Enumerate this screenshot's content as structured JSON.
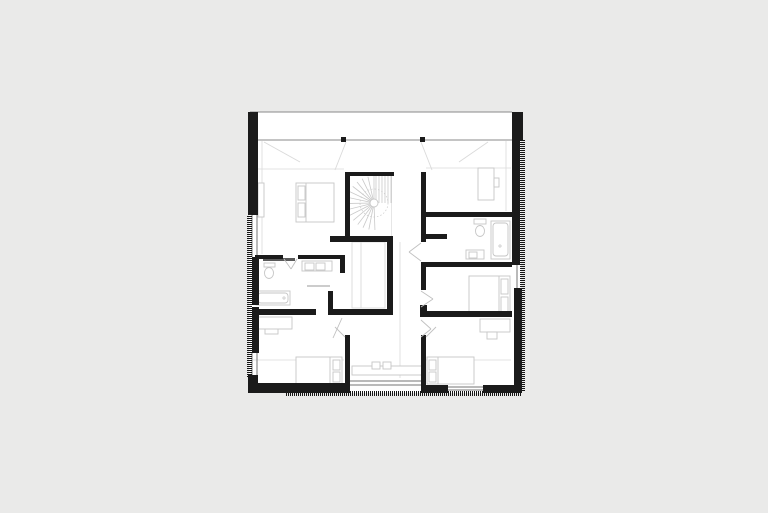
{
  "meta": {
    "type": "architectural-floor-plan",
    "description": "black-and-white attic floor plan with central spiral stair, bedrooms, two bathrooms and hatched exterior wall edges, centered on a light grey page"
  },
  "canvas": {
    "width": 768,
    "height": 513
  },
  "colors": {
    "background": "#eaeae9",
    "floor": "#ffffff",
    "wall": "#1b1b1b",
    "hatch": "#161616",
    "thin_line": "#757575",
    "band_line": "#8a8a8a",
    "faint_line": "#dadada",
    "furniture": "#c6c6c6",
    "stair_line": "#c9c9c9",
    "swing_line": "#c0c0c0",
    "slider_door": "#5a5a5a"
  },
  "plan": {
    "floor_rect": [
      249,
      112,
      272,
      281
    ],
    "band_lines": [
      [
        250,
        112,
        512,
        112
      ],
      [
        252,
        140,
        512,
        140
      ]
    ],
    "columns": [
      [
        341,
        137,
        5,
        5
      ],
      [
        420,
        137,
        5,
        5
      ]
    ],
    "walls": [
      [
        248,
        112,
        10,
        103
      ],
      [
        252,
        257,
        7,
        48
      ],
      [
        252,
        307,
        7,
        46
      ],
      [
        248,
        375,
        10,
        18
      ],
      [
        248,
        383,
        97,
        10
      ],
      [
        345,
        335,
        5,
        58
      ],
      [
        421,
        335,
        5,
        58
      ],
      [
        425,
        385,
        23,
        8
      ],
      [
        483,
        385,
        39,
        8
      ],
      [
        512,
        112,
        11,
        28
      ],
      [
        512,
        140,
        8,
        125
      ],
      [
        514,
        288,
        8,
        99
      ],
      [
        345,
        172,
        49,
        4
      ],
      [
        345,
        172,
        5,
        65
      ],
      [
        330,
        236,
        62,
        6
      ],
      [
        387,
        236,
        6,
        79
      ],
      [
        252,
        309,
        64,
        6
      ],
      [
        328,
        309,
        65,
        6
      ],
      [
        328,
        291,
        5,
        24
      ],
      [
        255,
        255,
        28,
        4
      ],
      [
        298,
        255,
        47,
        4
      ],
      [
        340,
        255,
        5,
        18
      ],
      [
        421,
        172,
        5,
        70
      ],
      [
        425,
        234,
        22,
        5
      ],
      [
        421,
        212,
        91,
        5
      ],
      [
        421,
        262,
        91,
        5
      ],
      [
        421,
        262,
        5,
        28
      ],
      [
        420,
        311,
        92,
        6
      ],
      [
        420,
        305,
        7,
        6
      ]
    ],
    "hatch_strips": {
      "left": [
        247,
        215,
        5,
        163
      ],
      "right": [
        520,
        140,
        5,
        252
      ],
      "bottom": [
        286,
        391,
        235,
        5
      ]
    },
    "window_lines": [
      [
        252,
        215,
        252,
        257
      ],
      [
        257,
        215,
        257,
        257
      ],
      [
        252,
        353,
        252,
        375
      ],
      [
        257,
        353,
        257,
        375
      ],
      [
        517,
        264,
        517,
        289
      ],
      [
        350,
        381,
        421,
        381
      ],
      [
        350,
        385,
        421,
        385
      ],
      [
        448,
        387,
        483,
        387
      ],
      [
        448,
        390,
        483,
        390
      ]
    ],
    "faint_lines": [
      [
        253,
        360,
        344,
        360
      ],
      [
        426,
        360,
        511,
        360
      ],
      [
        262,
        141,
        262,
        254
      ],
      [
        506,
        141,
        506,
        211
      ],
      [
        400,
        242,
        400,
        378
      ],
      [
        253,
        169,
        344,
        169
      ],
      [
        426,
        168,
        511,
        168
      ]
    ],
    "roof_splays": [
      [
        264,
        142,
        300,
        162
      ],
      [
        488,
        142,
        459,
        162
      ],
      [
        346,
        142,
        335,
        170
      ],
      [
        421,
        142,
        432,
        170
      ]
    ],
    "door_swings": [
      [
        421,
        243,
        409,
        252
      ],
      [
        409,
        252,
        421,
        261
      ],
      [
        421,
        291,
        433,
        299
      ],
      [
        433,
        299,
        421,
        307
      ],
      [
        421,
        320,
        431,
        329
      ],
      [
        431,
        329,
        421,
        337
      ],
      [
        284,
        259,
        291,
        269
      ],
      [
        291,
        269,
        297,
        259
      ],
      [
        342,
        318,
        333,
        338
      ],
      [
        345,
        337,
        335,
        327
      ],
      [
        426,
        337,
        436,
        327
      ]
    ],
    "stair": {
      "box": [
        350,
        176,
        42,
        61
      ],
      "cx": 374,
      "cy": 203,
      "hub_r": 4,
      "fan": {
        "r": 27,
        "start": 88,
        "end": 272,
        "step": 13
      },
      "treads_x": [
        376,
        379,
        382,
        385,
        388,
        391
      ],
      "treads_y_top": 176,
      "treads_y_bottom": 203,
      "edge_x": 392,
      "walk_r": 14
    },
    "furniture": {
      "beds": [
        {
          "rect": [
            296,
            183,
            38,
            39
          ],
          "divider_x": 306,
          "pillows": [
            [
              298,
              186,
              7,
              14
            ],
            [
              298,
              203,
              7,
              14
            ]
          ]
        },
        {
          "rect": [
            469,
            276,
            41,
            38
          ],
          "divider_x": 499,
          "pillows": [
            [
              501,
              279,
              7,
              15
            ],
            [
              501,
              297,
              7,
              15
            ]
          ]
        },
        {
          "rect": [
            427,
            357,
            47,
            27
          ],
          "divider_x": 438,
          "pillows": [
            [
              429,
              360,
              7,
              10
            ],
            [
              429,
              372,
              7,
              10
            ]
          ]
        },
        {
          "rect": [
            296,
            357,
            46,
            27
          ],
          "divider_x": 330,
          "pillows": [
            [
              333,
              360,
              7,
              10
            ],
            [
              333,
              372,
              7,
              10
            ]
          ]
        }
      ],
      "desks": [
        {
          "rect": [
            478,
            168,
            16,
            32
          ],
          "chair": [
            494,
            178,
            5,
            9
          ]
        },
        {
          "rect": [
            480,
            319,
            30,
            13
          ],
          "chair": [
            487,
            332,
            10,
            7
          ]
        }
      ],
      "cabinets": [
        [
          258,
          183,
          6,
          34
        ],
        [
          265,
          324,
          13,
          10
        ],
        [
          254,
          317,
          38,
          12
        ]
      ],
      "sideboard": {
        "rect": [
          352,
          366,
          70,
          9
        ],
        "boxes": [
          [
            372,
            362,
            8,
            7
          ],
          [
            383,
            362,
            8,
            7
          ]
        ]
      },
      "bath_right": {
        "toilet": {
          "tank": [
            474,
            219,
            12,
            5
          ],
          "bowl": [
            480,
            231,
            4.5,
            5.5
          ]
        },
        "tub": {
          "outer": [
            491,
            221,
            19,
            38
          ],
          "inner": [
            493,
            223,
            15,
            33
          ],
          "drain": [
            500,
            246
          ]
        },
        "sink": {
          "rect": [
            466,
            250,
            18,
            9
          ],
          "basin": [
            469,
            252,
            8,
            6
          ]
        }
      },
      "bath_left": {
        "toilet": {
          "tank": [
            264,
            263,
            11,
            4
          ],
          "bowl": [
            269,
            273,
            4.5,
            5.5
          ]
        },
        "counter": {
          "rect": [
            302,
            261,
            30,
            10
          ],
          "basins": [
            [
              305,
              263,
              9,
              7
            ],
            [
              316,
              263,
              9,
              7
            ]
          ]
        },
        "tub": {
          "outer": [
            256,
            291,
            34,
            14
          ],
          "inner": [
            258,
            293,
            30,
            10
          ],
          "drain": [
            284,
            298
          ]
        },
        "slider": [
          263,
          258,
          32,
          3
        ],
        "shower_line": [
          307,
          286,
          330,
          286
        ]
      },
      "closet": {
        "rect": [
          352,
          242,
          33,
          66
        ],
        "divider": [
          361,
          242,
          361,
          308
        ]
      }
    }
  }
}
